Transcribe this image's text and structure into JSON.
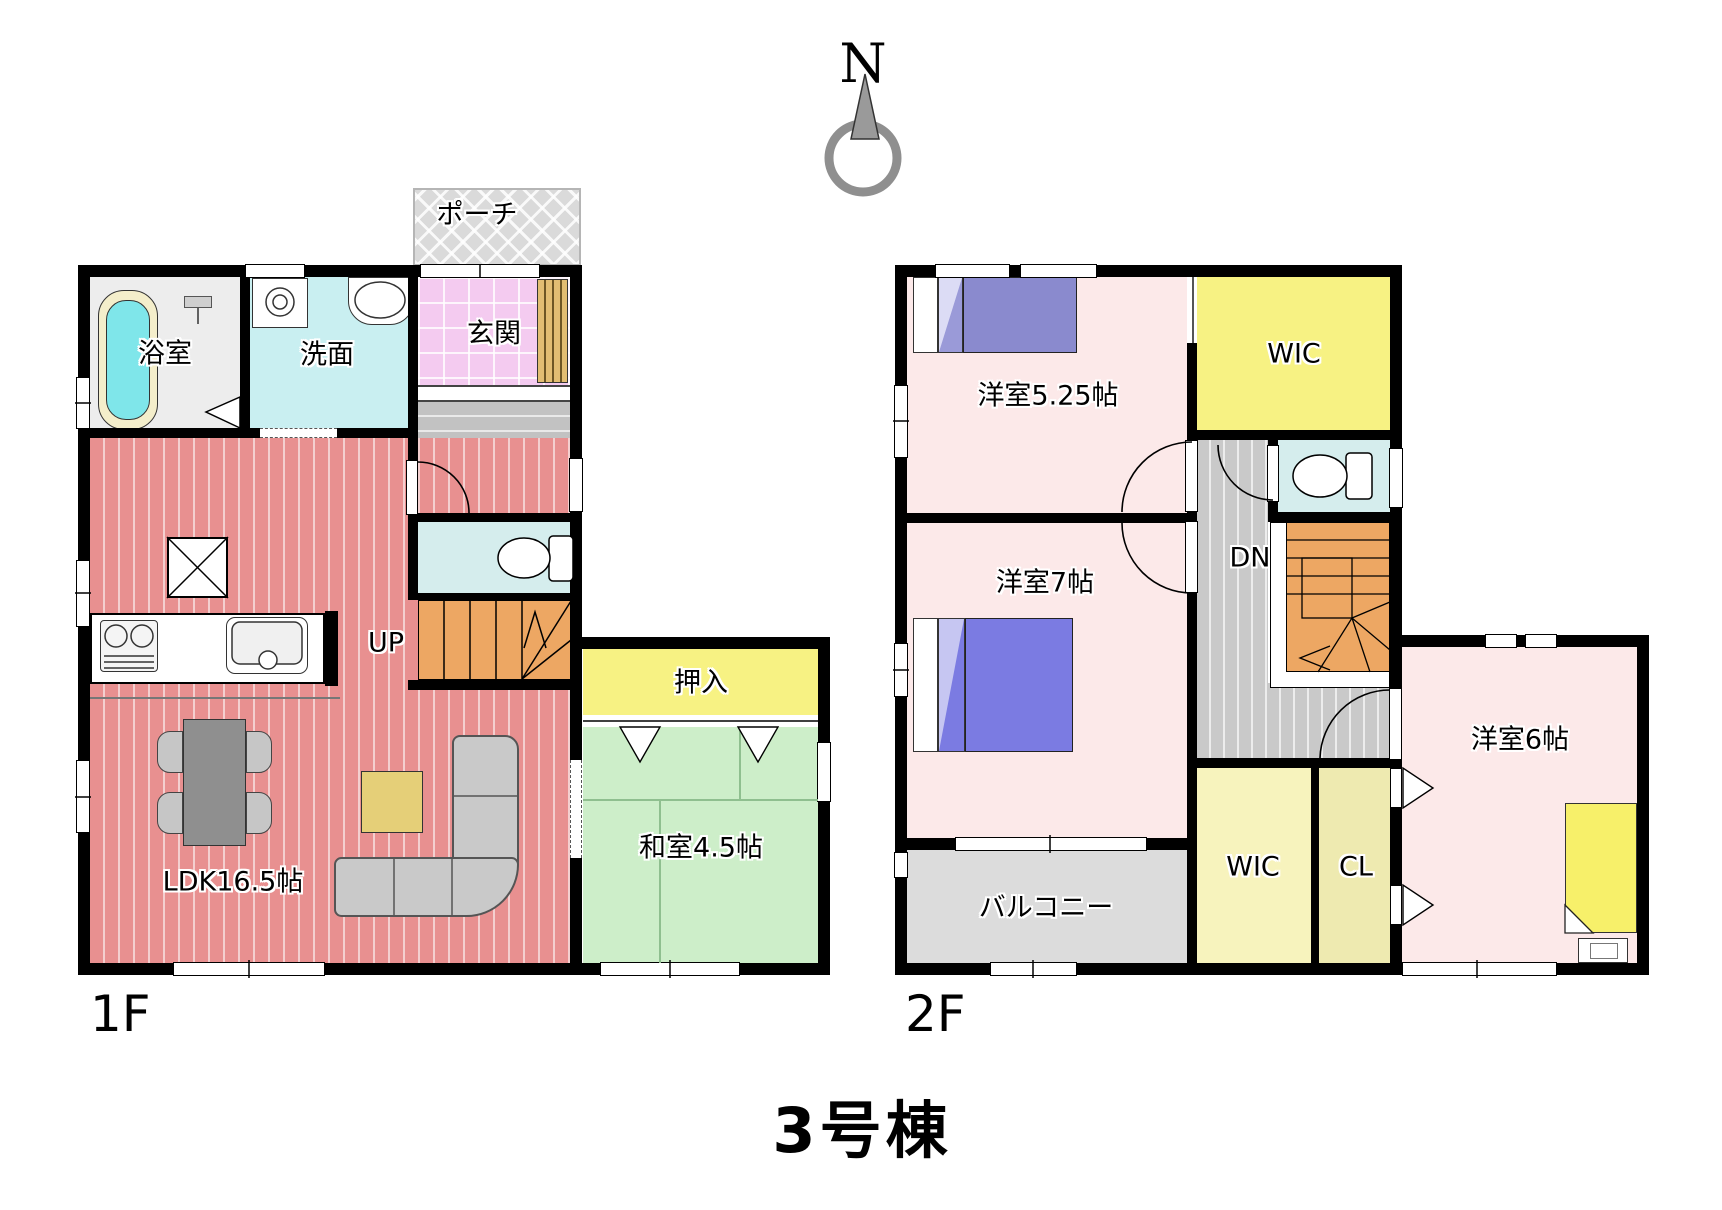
{
  "title": "3号棟",
  "compass": {
    "north_label": "N"
  },
  "floor1": {
    "label": "1F",
    "rooms": {
      "bath": "浴室",
      "wash": "洗面",
      "entrance": "玄関",
      "porch": "ポーチ",
      "ldk": "LDK16.5帖",
      "stairs_up": "UP",
      "closet": "押入",
      "japanese_room": "和室4.5帖"
    }
  },
  "floor2": {
    "label": "2F",
    "rooms": {
      "bedroom_525": "洋室5.25帖",
      "wic_top": "WIC",
      "stairs_down": "DN",
      "bedroom_7": "洋室7帖",
      "bedroom_6": "洋室6帖",
      "wic_bottom": "WIC",
      "cl": "CL",
      "balcony": "バルコニー"
    }
  }
}
